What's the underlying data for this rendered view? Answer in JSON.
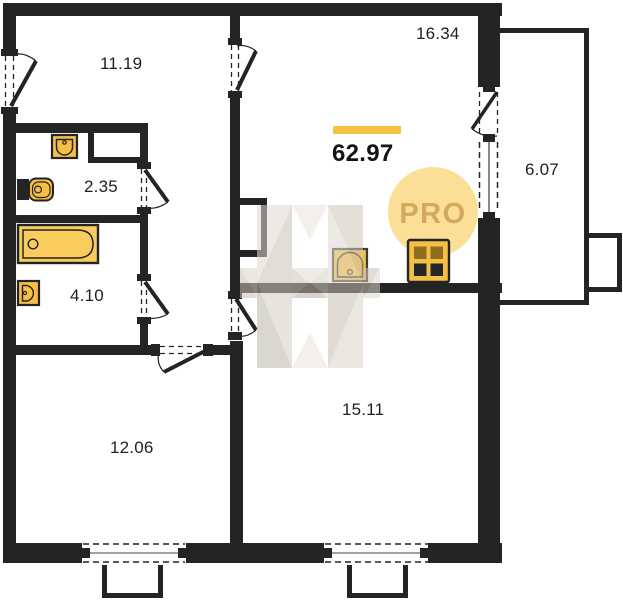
{
  "title": "Apartment floor plan",
  "total": {
    "value": "62.97"
  },
  "rooms": [
    {
      "name": "hallway",
      "area": "11.19"
    },
    {
      "name": "kitchen-living",
      "area": "16.34"
    },
    {
      "name": "wc",
      "area": "2.35"
    },
    {
      "name": "bathroom",
      "area": "4.10"
    },
    {
      "name": "bedroom",
      "area": "12.06"
    },
    {
      "name": "living-room",
      "area": "15.11"
    },
    {
      "name": "balcony",
      "area": "6.07"
    }
  ],
  "badge": {
    "label": "PRO"
  },
  "watermark": {
    "letter": "H"
  },
  "icons": [
    "bathtub-icon",
    "toilet-icon",
    "wc-sink-icon",
    "bath-sink-icon",
    "kitchen-sink-icon",
    "stove-icon"
  ],
  "colors": {
    "wall": "#242424",
    "fixture": "#F5BE44",
    "bathtub": "#F9CC5E",
    "accent_bar": "#F6C244",
    "badge_bg": "#FBDF96",
    "badge_text": "#D3A95C",
    "watermark_beige": "#D2CABE"
  }
}
